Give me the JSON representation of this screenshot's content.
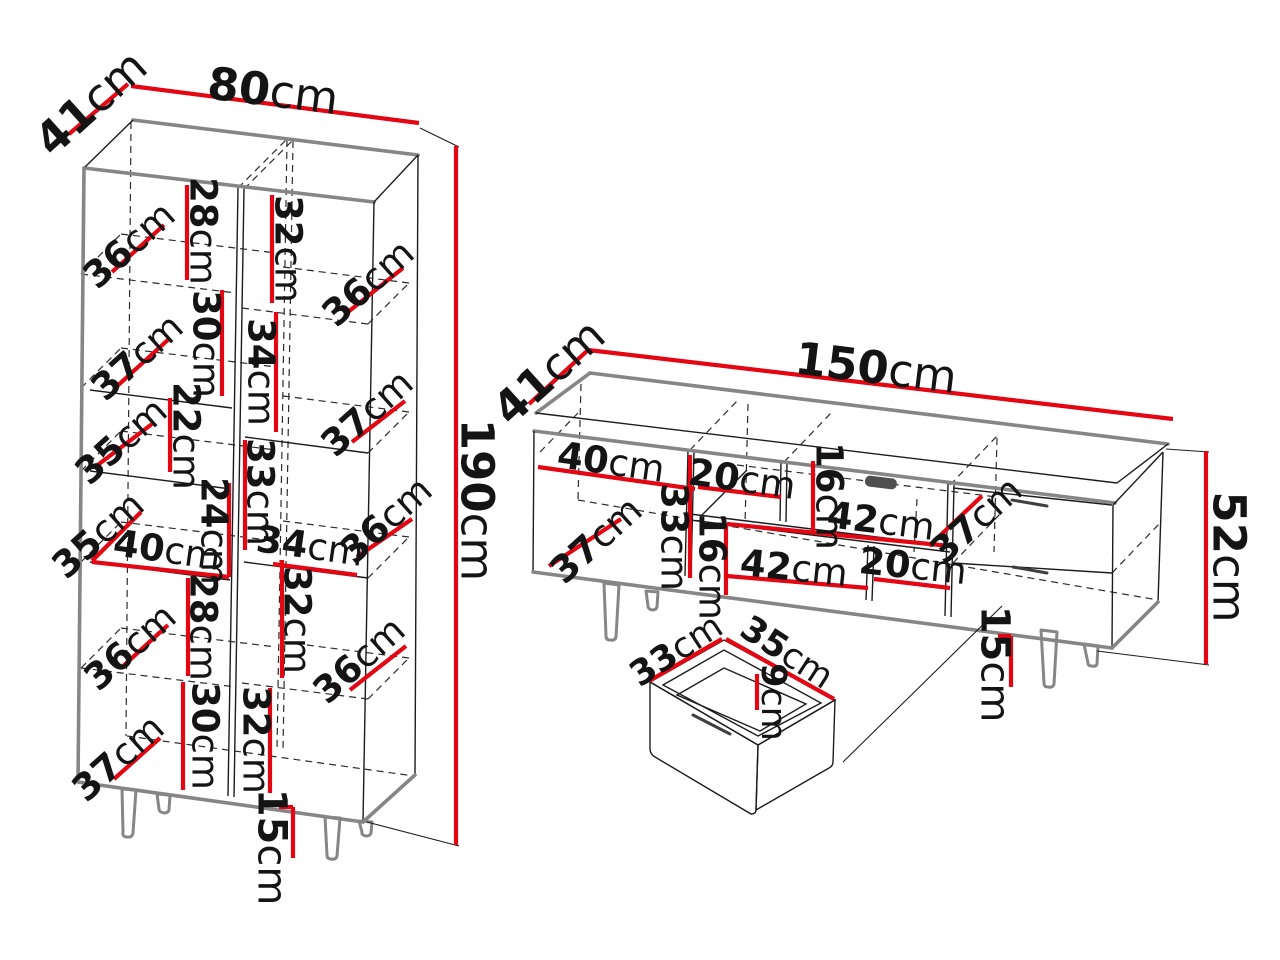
{
  "diagram_title": "furniture-dimension-diagram",
  "colors": {
    "dimension_red": "#e30613",
    "silhouette_gray": "#868686",
    "edge_black": "#1c1c1c"
  },
  "cabinet": {
    "dims": [
      {
        "name": "depth",
        "num": "41",
        "unit": "cm"
      },
      {
        "name": "width",
        "num": "80",
        "unit": "cm"
      },
      {
        "name": "height",
        "num": "190",
        "unit": "cm"
      },
      {
        "name": "left-row1-depth",
        "num": "36",
        "unit": "cm"
      },
      {
        "name": "left-row1-height",
        "num": "28",
        "unit": "cm"
      },
      {
        "name": "right-row1-height",
        "num": "32",
        "unit": "cm"
      },
      {
        "name": "right-row1-depth",
        "num": "36",
        "unit": "cm"
      },
      {
        "name": "left-row2-depth",
        "num": "37",
        "unit": "cm"
      },
      {
        "name": "left-row2-height",
        "num": "30",
        "unit": "cm"
      },
      {
        "name": "right-row2-height",
        "num": "34",
        "unit": "cm"
      },
      {
        "name": "right-row2-depth",
        "num": "37",
        "unit": "cm"
      },
      {
        "name": "left-row3-depth",
        "num": "35",
        "unit": "cm"
      },
      {
        "name": "left-row3-height",
        "num": "22",
        "unit": "cm"
      },
      {
        "name": "left-row4-height",
        "num": "24",
        "unit": "cm"
      },
      {
        "name": "right-row3-height",
        "num": "33",
        "unit": "cm"
      },
      {
        "name": "left-row4-depth",
        "num": "35",
        "unit": "cm"
      },
      {
        "name": "left-row4-width",
        "num": "40",
        "unit": "cm"
      },
      {
        "name": "right-row3-width",
        "num": "34",
        "unit": "cm"
      },
      {
        "name": "right-row3-depth",
        "num": "36",
        "unit": "cm"
      },
      {
        "name": "left-row5-height",
        "num": "28",
        "unit": "cm"
      },
      {
        "name": "right-row4-height",
        "num": "32",
        "unit": "cm"
      },
      {
        "name": "left-row5-depth",
        "num": "36",
        "unit": "cm"
      },
      {
        "name": "right-row4-depth",
        "num": "36",
        "unit": "cm"
      },
      {
        "name": "left-row6-height",
        "num": "30",
        "unit": "cm"
      },
      {
        "name": "right-row5-height",
        "num": "32",
        "unit": "cm"
      },
      {
        "name": "left-row6-depth",
        "num": "37",
        "unit": "cm"
      },
      {
        "name": "leg-height",
        "num": "15",
        "unit": "cm"
      }
    ]
  },
  "tv_stand": {
    "dims": [
      {
        "name": "depth",
        "num": "41",
        "unit": "cm"
      },
      {
        "name": "width",
        "num": "150",
        "unit": "cm"
      },
      {
        "name": "height",
        "num": "52",
        "unit": "cm"
      },
      {
        "name": "left-compartment-width",
        "num": "40",
        "unit": "cm"
      },
      {
        "name": "niche-width",
        "num": "20",
        "unit": "cm"
      },
      {
        "name": "niche-height",
        "num": "16",
        "unit": "cm"
      },
      {
        "name": "shelf-width",
        "num": "42",
        "unit": "cm"
      },
      {
        "name": "drawer-depth",
        "num": "37",
        "unit": "cm"
      },
      {
        "name": "left-compartment-depth",
        "num": "37",
        "unit": "cm"
      },
      {
        "name": "interior-height",
        "num": "33",
        "unit": "cm"
      },
      {
        "name": "lower-niche-height",
        "num": "16",
        "unit": "cm"
      },
      {
        "name": "lower-shelf-width",
        "num": "42",
        "unit": "cm"
      },
      {
        "name": "lower-niche-width",
        "num": "20",
        "unit": "cm"
      },
      {
        "name": "leg-height",
        "num": "15",
        "unit": "cm"
      }
    ]
  },
  "drawer": {
    "dims": [
      {
        "name": "width",
        "num": "33",
        "unit": "cm"
      },
      {
        "name": "depth",
        "num": "35",
        "unit": "cm"
      },
      {
        "name": "height",
        "num": "9",
        "unit": "cm"
      }
    ]
  }
}
